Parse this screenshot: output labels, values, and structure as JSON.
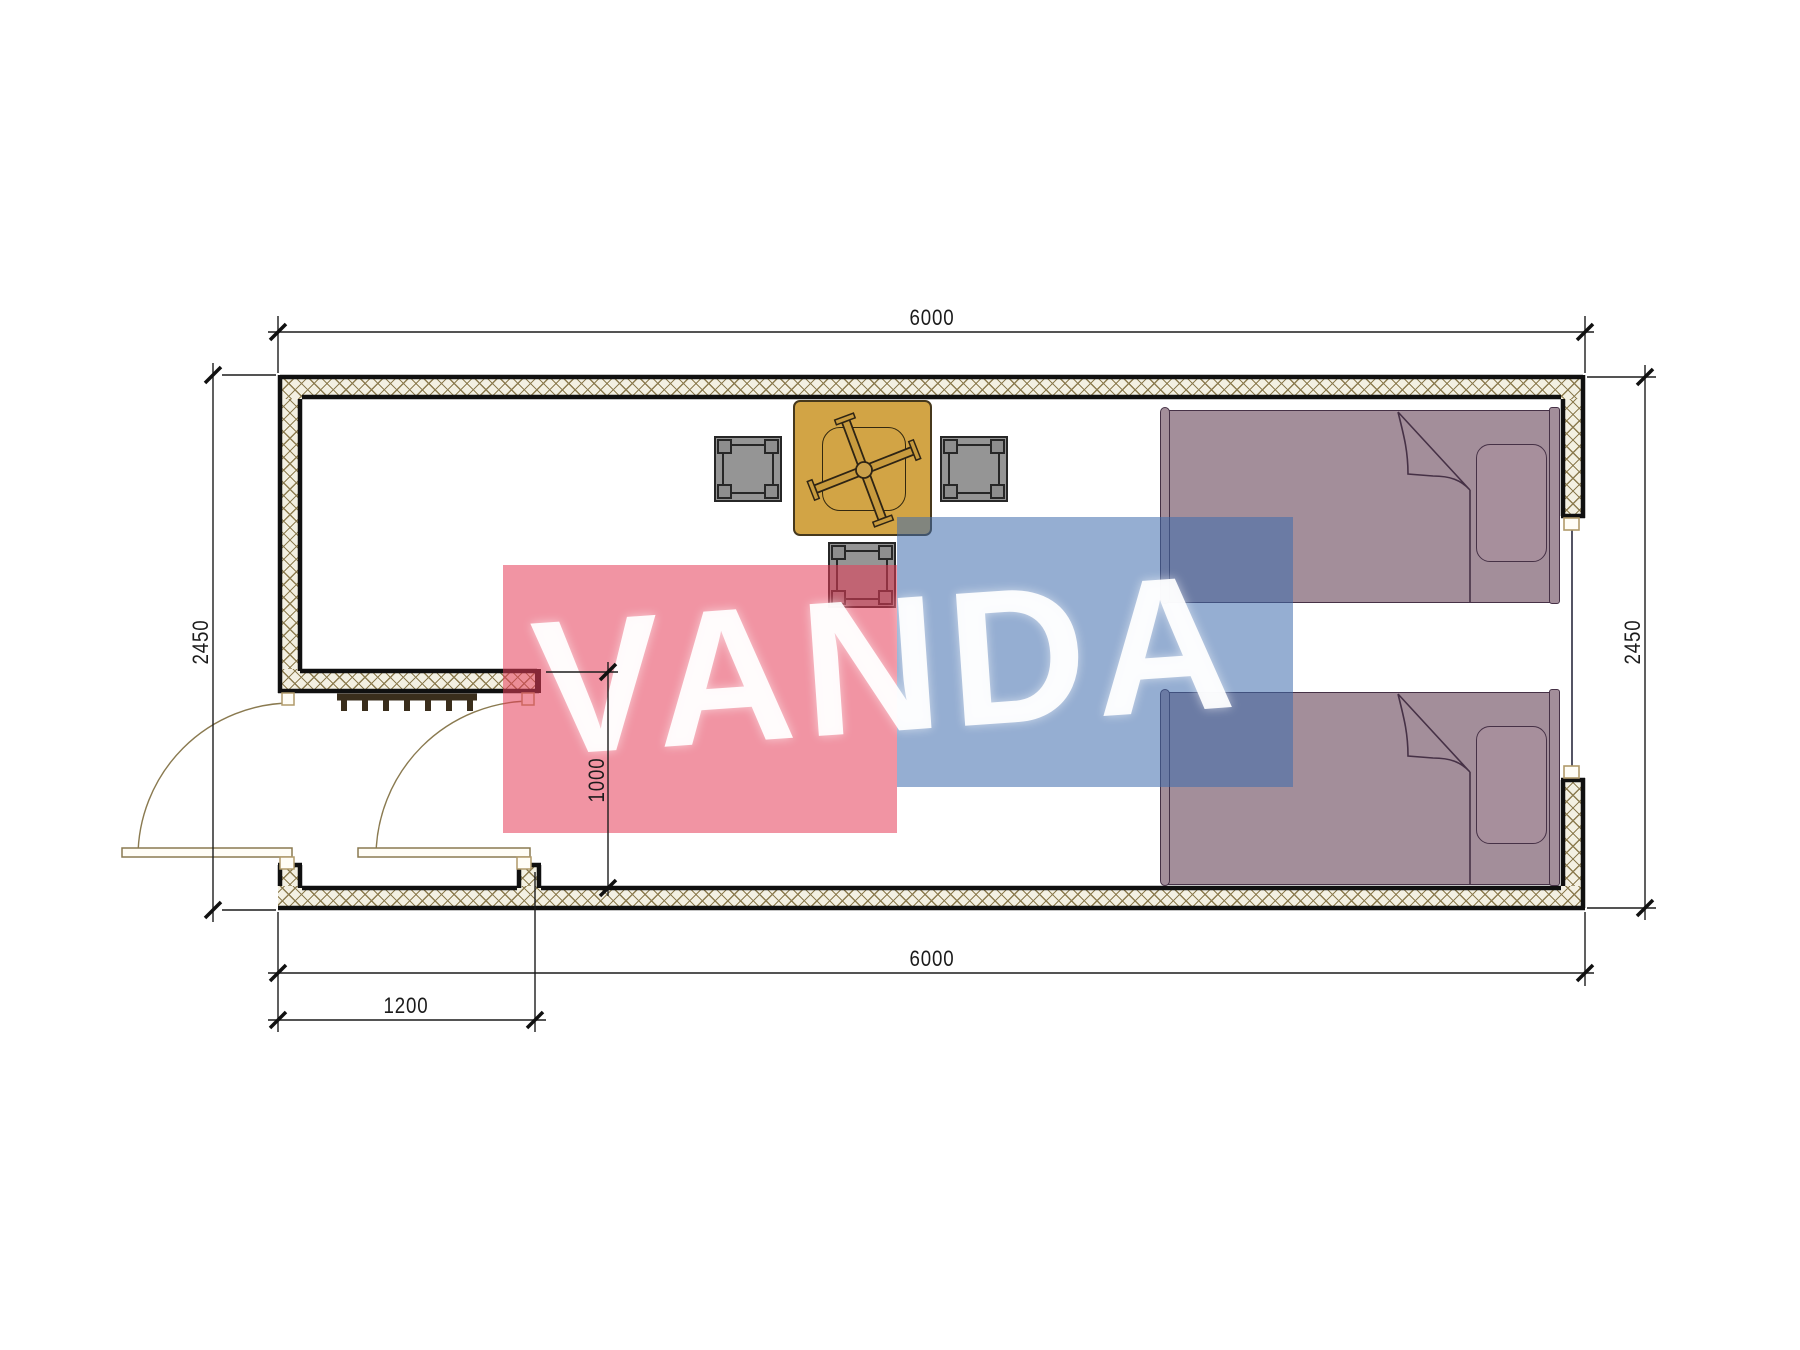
{
  "title": "Container house floor plan 6000 x 2450",
  "dimensions": {
    "top_width": "6000",
    "bottom_width": "6000",
    "left_height": "2450",
    "right_height": "2450",
    "porch_width": "1200",
    "porch_depth": "1000"
  },
  "watermark": {
    "text": "VANDA",
    "red_block_color": "rgba(229,60,88,0.55)",
    "blue_block_color": "rgba(62,108,173,0.55)"
  },
  "palette": {
    "wall_fill": "#f3f0e2",
    "hatch_line": "#8c7c50",
    "line": "#101010",
    "table_fill": "#d2a445",
    "table_line": "#46381c",
    "stool_fill": "#959595",
    "stool_line": "#272727",
    "bed_fill": "#a38e9a",
    "bed_line": "#463146",
    "door_line": "#8a7a50",
    "jamb_line": "#b09a6a",
    "comb": "#3a2e1c",
    "dim": "#1b1b1b",
    "red": "rgba(229,60,88,0.55)",
    "blue": "rgba(62,108,173,0.55)",
    "wm_text": "rgba(255,255,255,0.93)"
  }
}
